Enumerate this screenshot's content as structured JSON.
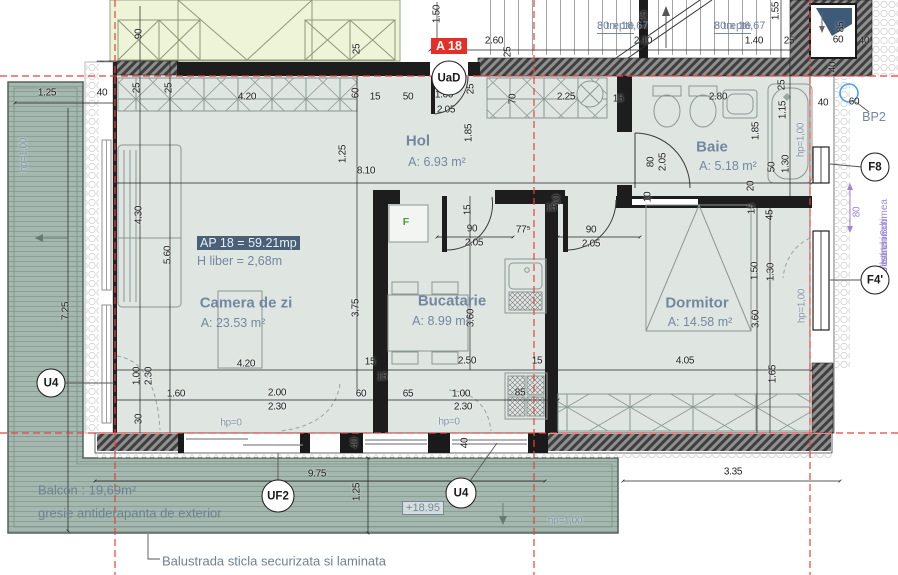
{
  "plan": {
    "badge": "A 18",
    "apartment_label": "AP 18 = 59.21mp",
    "height_label": "H liber = 2,68m",
    "fridge_label": "F",
    "accent_colors": {
      "axis_red": "#e8423a",
      "note_purple": "#a08cd6",
      "label_blue": "#7487a0"
    },
    "rooms": [
      {
        "name": "Hol",
        "area": "A: 6.93 m²",
        "nx": 418,
        "ny": 141,
        "ax": 437,
        "ay": 162
      },
      {
        "name": "Baie",
        "area": "A: 5.18 m²",
        "nx": 712,
        "ny": 147,
        "ax": 728,
        "ay": 166
      },
      {
        "name": "Camera de zi",
        "area": "A: 23.53 m²",
        "nx": 246,
        "ny": 303,
        "ax": 233,
        "ay": 323
      },
      {
        "name": "Bucatarie",
        "area": "A: 8.99 m²",
        "nx": 452,
        "ny": 301,
        "ax": 441,
        "ay": 321
      },
      {
        "name": "Dormitor",
        "area": "A: 14.58 m²",
        "nx": 697,
        "ny": 303,
        "ax": 700,
        "ay": 322
      }
    ],
    "stairs": [
      {
        "top": "8 trepte",
        "bottom": "30 x 16,67",
        "x": 597,
        "y": 20
      },
      {
        "top": "8 trepte",
        "bottom": "30 x 16,67",
        "x": 714,
        "y": 20
      }
    ],
    "markers": [
      {
        "label": "UaD",
        "x": 449,
        "y": 78,
        "d": 33
      },
      {
        "label": "U4",
        "x": 51,
        "y": 383,
        "d": 27
      },
      {
        "label": "UF2",
        "x": 278,
        "y": 496,
        "d": 31
      },
      {
        "label": "U4",
        "x": 461,
        "y": 493,
        "d": 29
      },
      {
        "label": "F8",
        "x": 875,
        "y": 167,
        "d": 27
      },
      {
        "label": "F4'",
        "x": 875,
        "y": 280,
        "d": 27
      }
    ],
    "bp2": {
      "label": "BP2",
      "x": 874,
      "y": 117
    },
    "balcony": {
      "area_label": "Balcon : 19,69m²",
      "floor_note": "gresie antiderapanta de exterior",
      "railing_note": "Balustrada sticla securizata si laminata",
      "level": "+18.95"
    },
    "insulation_note": {
      "lines": [
        "polistiren 8cm",
        "pe toata inaltimea",
        "ferestrelor"
      ],
      "x": 879,
      "y": 278
    },
    "dims": [
      {
        "t": "1.25",
        "x": 47,
        "y": 93
      },
      {
        "t": "40",
        "x": 102,
        "y": 93
      },
      {
        "t": "90",
        "x": 139,
        "y": 34,
        "r": -90
      },
      {
        "t": "25",
        "x": 357,
        "y": 49,
        "r": -90
      },
      {
        "t": "1.50",
        "x": 437,
        "y": 14,
        "r": -90
      },
      {
        "t": "2.60",
        "x": 494,
        "y": 41
      },
      {
        "t": "25",
        "x": 508,
        "y": 52,
        "r": -90
      },
      {
        "t": "1.25",
        "x": 644,
        "y": 20,
        "r": -90
      },
      {
        "t": "2.10",
        "x": 643,
        "y": 41
      },
      {
        "t": "1.40",
        "x": 754,
        "y": 41
      },
      {
        "t": "25",
        "x": 789,
        "y": 41
      },
      {
        "t": "1.55",
        "x": 776,
        "y": 11,
        "r": -90
      },
      {
        "t": "85",
        "x": 841,
        "y": 27,
        "r": -90
      },
      {
        "t": "60",
        "x": 838,
        "y": 40
      },
      {
        "t": "40",
        "x": 864,
        "y": 41
      },
      {
        "t": "40",
        "x": 833,
        "y": 67,
        "r": -90
      },
      {
        "t": "25",
        "x": 137,
        "y": 88,
        "r": -90
      },
      {
        "t": "25",
        "x": 169,
        "y": 88,
        "r": -90
      },
      {
        "t": "4.20",
        "x": 247,
        "y": 97
      },
      {
        "t": "60",
        "x": 356,
        "y": 93,
        "r": -90
      },
      {
        "t": "15",
        "x": 375,
        "y": 97
      },
      {
        "t": "50",
        "x": 408,
        "y": 97
      },
      {
        "t": "1.00",
        "x": 444,
        "y": 95
      },
      {
        "t": "2.05",
        "x": 446,
        "y": 110
      },
      {
        "t": "25",
        "x": 471,
        "y": 89,
        "r": -90
      },
      {
        "t": "1.85",
        "x": 469,
        "y": 133,
        "r": -90
      },
      {
        "t": "70",
        "x": 513,
        "y": 99,
        "r": -90
      },
      {
        "t": "2.25",
        "x": 566,
        "y": 97
      },
      {
        "t": "15",
        "x": 618,
        "y": 99
      },
      {
        "t": "2.80",
        "x": 718,
        "y": 97
      },
      {
        "t": "25",
        "x": 782,
        "y": 85,
        "r": -90
      },
      {
        "t": "1.15",
        "x": 783,
        "y": 110,
        "r": -90
      },
      {
        "t": "40",
        "x": 823,
        "y": 103
      },
      {
        "t": "60",
        "x": 854,
        "y": 102
      },
      {
        "t": "1.85",
        "x": 756,
        "y": 131,
        "r": -90
      },
      {
        "t": "1.25",
        "x": 343,
        "y": 154,
        "r": -90
      },
      {
        "t": "8.10",
        "x": 366,
        "y": 171
      },
      {
        "t": "80",
        "x": 651,
        "y": 162,
        "r": -90
      },
      {
        "t": "2.05",
        "x": 663,
        "y": 162,
        "r": -90
      },
      {
        "t": "50",
        "x": 772,
        "y": 167,
        "r": -90
      },
      {
        "t": "1.30",
        "x": 786,
        "y": 164,
        "r": -90
      },
      {
        "t": "hp=1,00",
        "x": 801,
        "y": 140,
        "r": -90,
        "c": "g"
      },
      {
        "t": "20",
        "x": 751,
        "y": 186,
        "r": -90
      },
      {
        "t": "15",
        "x": 752,
        "y": 209,
        "r": -90
      },
      {
        "t": "45",
        "x": 770,
        "y": 215,
        "r": -90
      },
      {
        "t": "10",
        "x": 557,
        "y": 200,
        "r": -90
      },
      {
        "t": "15",
        "x": 468,
        "y": 210,
        "r": -90
      },
      {
        "t": "10",
        "x": 648,
        "y": 197,
        "r": -90
      },
      {
        "t": "90",
        "x": 472,
        "y": 229
      },
      {
        "t": "2.05",
        "x": 474,
        "y": 243
      },
      {
        "t": "77⁵",
        "x": 523,
        "y": 230
      },
      {
        "t": "15",
        "x": 551,
        "y": 208
      },
      {
        "t": "90",
        "x": 591,
        "y": 230
      },
      {
        "t": "2.05",
        "x": 591,
        "y": 244
      },
      {
        "t": "4.30",
        "x": 139,
        "y": 215,
        "r": -90
      },
      {
        "t": "5.60",
        "x": 168,
        "y": 255,
        "r": -90
      },
      {
        "t": "3.75",
        "x": 356,
        "y": 308,
        "r": -90
      },
      {
        "t": "3.60",
        "x": 471,
        "y": 318,
        "r": -90
      },
      {
        "t": "3.60",
        "x": 756,
        "y": 319,
        "r": -90
      },
      {
        "t": "1.50",
        "x": 755,
        "y": 271,
        "r": -90
      },
      {
        "t": "1.30",
        "x": 771,
        "y": 272,
        "r": -90
      },
      {
        "t": "hp=1,00",
        "x": 802,
        "y": 306,
        "r": -90,
        "c": "g"
      },
      {
        "t": "80",
        "x": 857,
        "y": 212,
        "r": -90,
        "c": "p"
      },
      {
        "t": "15",
        "x": 370,
        "y": 362
      },
      {
        "t": "15",
        "x": 382,
        "y": 377
      },
      {
        "t": "4.20",
        "x": 246,
        "y": 364
      },
      {
        "t": "2.50",
        "x": 467,
        "y": 361
      },
      {
        "t": "15",
        "x": 537,
        "y": 361
      },
      {
        "t": "4.05",
        "x": 685,
        "y": 361
      },
      {
        "t": "1.65",
        "x": 773,
        "y": 374,
        "r": -90
      },
      {
        "t": "1.00",
        "x": 137,
        "y": 376,
        "r": -90
      },
      {
        "t": "2.30",
        "x": 149,
        "y": 376,
        "r": -90
      },
      {
        "t": "30",
        "x": 139,
        "y": 419,
        "r": -90
      },
      {
        "t": "1.60",
        "x": 176,
        "y": 394
      },
      {
        "t": "2.00",
        "x": 277,
        "y": 393
      },
      {
        "t": "2.30",
        "x": 277,
        "y": 407
      },
      {
        "t": "60",
        "x": 361,
        "y": 394
      },
      {
        "t": "65",
        "x": 408,
        "y": 394
      },
      {
        "t": "1.00",
        "x": 461,
        "y": 394
      },
      {
        "t": "2.30",
        "x": 463,
        "y": 407
      },
      {
        "t": "85",
        "x": 520,
        "y": 393
      },
      {
        "t": "hp=0",
        "x": 231,
        "y": 423,
        "c": "g"
      },
      {
        "t": "hp=0",
        "x": 449,
        "y": 422,
        "c": "g"
      },
      {
        "t": "40",
        "x": 355,
        "y": 443,
        "r": -90
      },
      {
        "t": "40",
        "x": 465,
        "y": 443,
        "r": -90
      },
      {
        "t": "9.75",
        "x": 317,
        "y": 474
      },
      {
        "t": "1.25",
        "x": 357,
        "y": 492,
        "r": -90
      },
      {
        "t": "3.35",
        "x": 733,
        "y": 472
      },
      {
        "t": "hp=1,00",
        "x": 565,
        "y": 521,
        "c": "g"
      },
      {
        "t": "hp=1,00",
        "x": 24,
        "y": 155,
        "r": -90,
        "c": "g"
      },
      {
        "t": "7.25",
        "x": 66,
        "y": 311,
        "r": -90
      }
    ]
  }
}
